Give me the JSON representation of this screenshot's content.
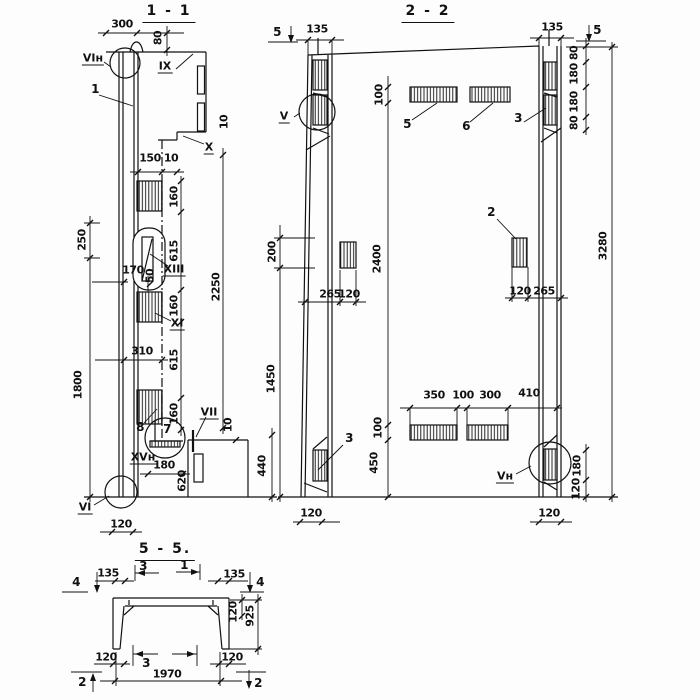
{
  "sections": {
    "s11": {
      "title": "1 - 1",
      "dims": {
        "d300": "300",
        "d80": "80",
        "d10x": "10",
        "d150": "150",
        "d10t": "10",
        "d160a": "160",
        "d615a": "615",
        "d160b": "160",
        "d615b": "615",
        "d160c": "160",
        "d2250": "2250",
        "d250": "250",
        "d170": "170",
        "d50": "50",
        "d310": "310",
        "d1800": "1800",
        "d10b": "10",
        "d440": "440",
        "d620": "620",
        "d180": "180",
        "d120": "120"
      },
      "marks": {
        "vi_n": "VIн",
        "ix": "IX",
        "x": "X",
        "xiii": "XIII",
        "xi": "XI",
        "vii": "VII",
        "xv_n": "XVн",
        "vi": "VI"
      },
      "parts": {
        "p1": "1",
        "p7": "7",
        "p8": "8"
      }
    },
    "s22": {
      "title": "2 - 2",
      "dims": {
        "d135l": "135",
        "d135r": "135",
        "d100t": "100",
        "d80a": "80",
        "d180a": "180",
        "d180b": "180",
        "d80b": "80",
        "d200": "200",
        "d2400": "2400",
        "d3280": "3280",
        "d265l": "265",
        "d120l": "120",
        "d120r": "120",
        "d265r": "265",
        "d1450": "1450",
        "d350": "350",
        "d100m": "100",
        "d300": "300",
        "d410": "410",
        "d100b": "100",
        "d450": "450",
        "d180r": "180",
        "d120rb": "120",
        "d120bl": "120",
        "d120br": "120"
      },
      "marks": {
        "v": "V",
        "v_n": "Vн",
        "s5l": "5",
        "s5r": "5"
      },
      "parts": {
        "p5": "5",
        "p6": "6",
        "p3t": "3",
        "p3b": "3",
        "p2": "2"
      }
    },
    "s55": {
      "title": "5 - 5.",
      "dims": {
        "d135l": "135",
        "d135r": "135",
        "d120r": "120",
        "d925": "925",
        "d120bl": "120",
        "d120br": "120",
        "d1970": "1970"
      },
      "marks": {
        "s4l": "4",
        "s4r": "4",
        "s3t": "3",
        "s1t": "1",
        "s3b": "3",
        "s2l": "2",
        "s2r": "2"
      }
    }
  }
}
